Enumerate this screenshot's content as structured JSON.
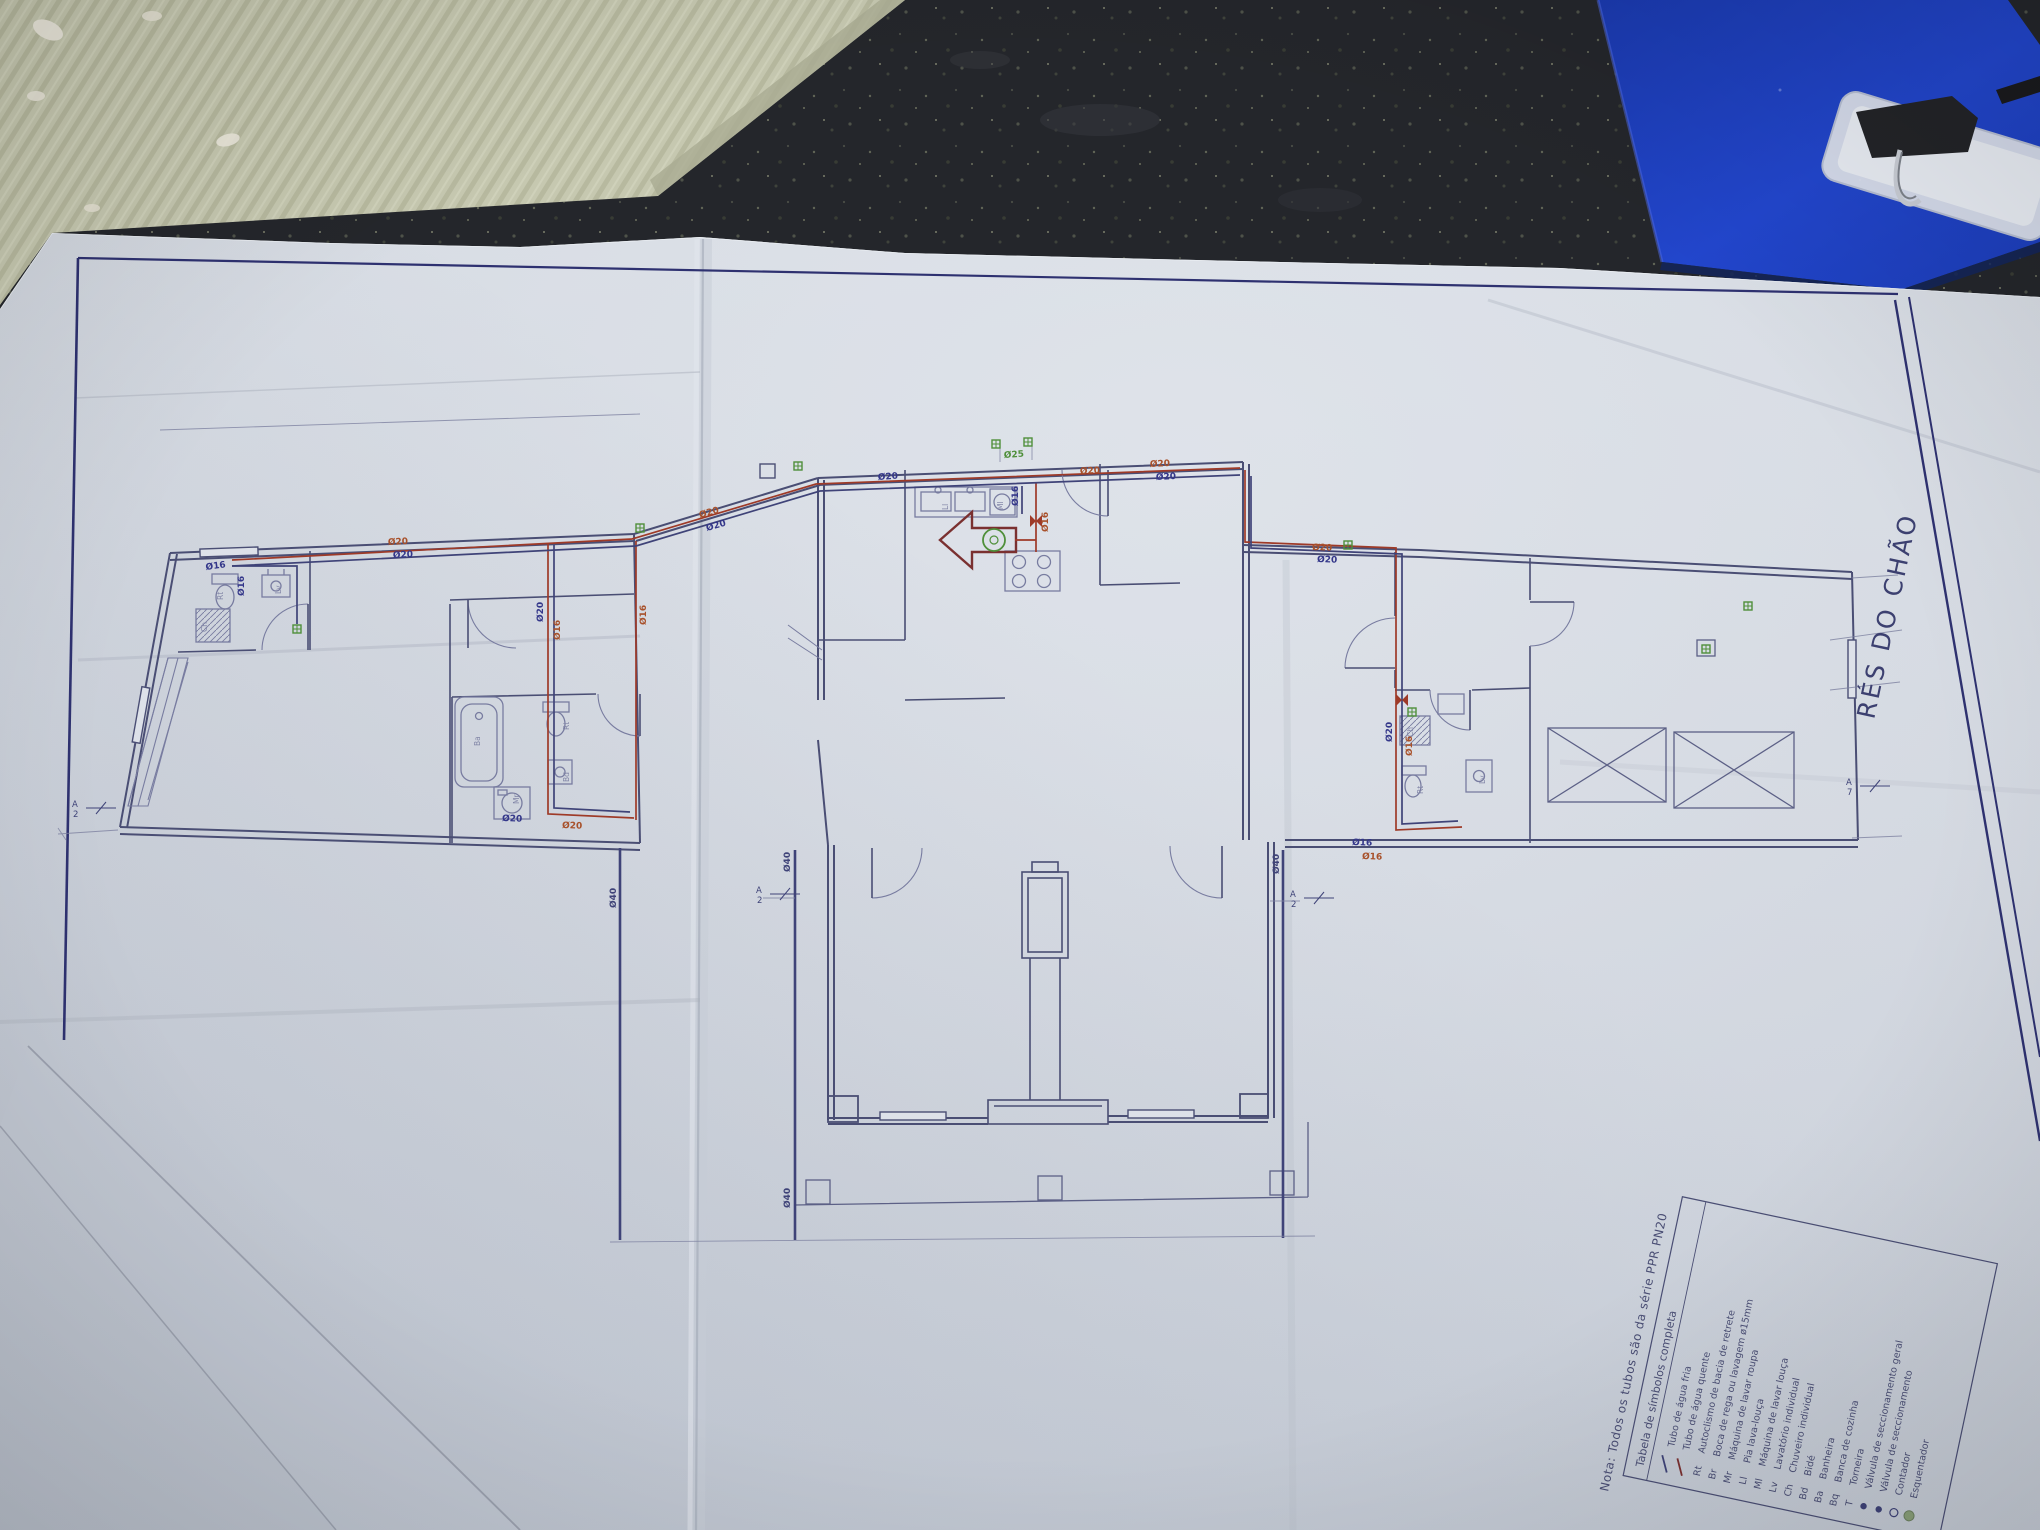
{
  "scene": {
    "description": "photo of a plumbing floor-plan blueprint lying on a dark speckled countertop",
    "objects": [
      "corrugated-cardboard",
      "dark-countertop",
      "blue-folder",
      "clipboard-clip",
      "blueprint-sheet"
    ]
  },
  "sheet": {
    "title": "RÉS DO CHÃO",
    "note": "Nota:  Todos os tubos são da série PPR PN20",
    "legend": {
      "title": "Tabela de símbolos completa",
      "rows": [
        {
          "symbol": "line-cold",
          "abbrev": "",
          "label": "Tubo de água fria"
        },
        {
          "symbol": "line-hot",
          "abbrev": "",
          "label": "Tubo de água quente"
        },
        {
          "symbol": "text",
          "abbrev": "Rt",
          "label": "Autoclismo de bacia de retrete"
        },
        {
          "symbol": "text",
          "abbrev": "Br",
          "label": "Boca de rega ou lavagem ø15mm"
        },
        {
          "symbol": "text",
          "abbrev": "Mr",
          "label": "Máquina de lavar roupa"
        },
        {
          "symbol": "text",
          "abbrev": "Ll",
          "label": "Pia lava-louça"
        },
        {
          "symbol": "text",
          "abbrev": "Ml",
          "label": "Máquina de lavar louça"
        },
        {
          "symbol": "text",
          "abbrev": "Lv",
          "label": "Lavatório individual"
        },
        {
          "symbol": "text",
          "abbrev": "Ch",
          "label": "Chuveiro individual"
        },
        {
          "symbol": "text",
          "abbrev": "Bd",
          "label": "Bidé"
        },
        {
          "symbol": "text",
          "abbrev": "Ba",
          "label": "Banheira"
        },
        {
          "symbol": "text",
          "abbrev": "Bq",
          "label": "Banca de cozinha"
        },
        {
          "symbol": "text",
          "abbrev": "T",
          "label": "Torneira"
        },
        {
          "symbol": "dot",
          "abbrev": "",
          "label": "Válvula de seccionamento geral"
        },
        {
          "symbol": "dot",
          "abbrev": "",
          "label": "Válvula de seccionamento"
        },
        {
          "symbol": "circle",
          "abbrev": "",
          "label": "Contador"
        },
        {
          "symbol": "disc",
          "abbrev": "",
          "label": "Esquentador"
        }
      ]
    },
    "pipe_labels": [
      {
        "t": "Ø16",
        "c": "cold",
        "x": 206,
        "y": 570,
        "r": -8
      },
      {
        "t": "Ø20",
        "c": "hot",
        "x": 388,
        "y": 545,
        "r": -3
      },
      {
        "t": "Ø20",
        "c": "cold",
        "x": 393,
        "y": 558,
        "r": -3
      },
      {
        "t": "Ø20",
        "c": "cold",
        "x": 543,
        "y": 622,
        "r": -90
      },
      {
        "t": "Ø16",
        "c": "hot",
        "x": 560,
        "y": 640,
        "r": -90
      },
      {
        "t": "Ø16",
        "c": "hot",
        "x": 646,
        "y": 625,
        "r": -90
      },
      {
        "t": "Ø20",
        "c": "hot",
        "x": 700,
        "y": 518,
        "r": -16
      },
      {
        "t": "Ø20",
        "c": "cold",
        "x": 707,
        "y": 531,
        "r": -16
      },
      {
        "t": "Ø20",
        "c": "cold",
        "x": 878,
        "y": 480,
        "r": -4
      },
      {
        "t": "Ø20",
        "c": "hot",
        "x": 1080,
        "y": 474,
        "r": -3
      },
      {
        "t": "Ø16",
        "c": "cold",
        "x": 1018,
        "y": 506,
        "r": -90
      },
      {
        "t": "Ø16",
        "c": "hot",
        "x": 1048,
        "y": 532,
        "r": -90
      },
      {
        "t": "Ø25",
        "c": "green",
        "x": 1004,
        "y": 458,
        "r": -4
      },
      {
        "t": "Ø20",
        "c": "hot",
        "x": 1150,
        "y": 467,
        "r": -3
      },
      {
        "t": "Ø20",
        "c": "cold",
        "x": 1156,
        "y": 480,
        "r": -3
      },
      {
        "t": "Ø20",
        "c": "hot",
        "x": 1312,
        "y": 550,
        "r": 2
      },
      {
        "t": "Ø20",
        "c": "cold",
        "x": 1317,
        "y": 562,
        "r": 2
      },
      {
        "t": "Ø20",
        "c": "cold",
        "x": 1392,
        "y": 742,
        "r": -90
      },
      {
        "t": "Ø16",
        "c": "hot",
        "x": 1412,
        "y": 756,
        "r": -90
      },
      {
        "t": "Ø16",
        "c": "cold",
        "x": 1352,
        "y": 845,
        "r": 2
      },
      {
        "t": "Ø16",
        "c": "hot",
        "x": 1362,
        "y": 859,
        "r": 2
      },
      {
        "t": "Ø20",
        "c": "cold",
        "x": 502,
        "y": 821,
        "r": 2
      },
      {
        "t": "Ø20",
        "c": "hot",
        "x": 562,
        "y": 828,
        "r": 2
      },
      {
        "t": "Ø40",
        "c": "ink",
        "x": 790,
        "y": 872,
        "r": -90
      },
      {
        "t": "Ø40",
        "c": "ink",
        "x": 790,
        "y": 1208,
        "r": -90
      },
      {
        "t": "Ø40",
        "c": "ink",
        "x": 1279,
        "y": 874,
        "r": -90
      },
      {
        "t": "Ø40",
        "c": "ink",
        "x": 616,
        "y": 908,
        "r": -90
      },
      {
        "t": "Ø16",
        "c": "cold",
        "x": 244,
        "y": 596,
        "r": -90
      }
    ],
    "fixture_labels": [
      {
        "t": "Rt",
        "x": 223,
        "y": 600
      },
      {
        "t": "Lv",
        "x": 281,
        "y": 594
      },
      {
        "t": "Ch",
        "x": 207,
        "y": 632
      },
      {
        "t": "Ba",
        "x": 480,
        "y": 746
      },
      {
        "t": "Rt",
        "x": 569,
        "y": 730
      },
      {
        "t": "Bd",
        "x": 569,
        "y": 782
      },
      {
        "t": "Mr",
        "x": 519,
        "y": 804
      },
      {
        "t": "Ll",
        "x": 948,
        "y": 510
      },
      {
        "t": "Ml",
        "x": 1003,
        "y": 510
      },
      {
        "t": "Rt",
        "x": 1423,
        "y": 794
      },
      {
        "t": "Lv",
        "x": 1485,
        "y": 784
      },
      {
        "t": "Ch",
        "x": 1413,
        "y": 737
      }
    ],
    "markers": [
      {
        "t": "A2",
        "x": 80,
        "y": 810
      },
      {
        "t": "A2",
        "x": 764,
        "y": 896
      },
      {
        "t": "A2",
        "x": 1298,
        "y": 900
      },
      {
        "t": "A7",
        "x": 1854,
        "y": 788
      }
    ],
    "green_markers": [
      {
        "x": 297,
        "y": 629
      },
      {
        "x": 640,
        "y": 528
      },
      {
        "x": 798,
        "y": 466
      },
      {
        "x": 996,
        "y": 444
      },
      {
        "x": 1028,
        "y": 442
      },
      {
        "x": 1348,
        "y": 545
      },
      {
        "x": 1412,
        "y": 712
      },
      {
        "x": 1706,
        "y": 649
      },
      {
        "x": 1748,
        "y": 606
      }
    ]
  },
  "colors": {
    "cold": "#34378a",
    "hot": "#a8512b",
    "green": "#4f8f3a",
    "ink": "#3f4378",
    "wall": "#4a4e74",
    "furniture": "#787ca0",
    "paper": "#cfd4dd",
    "folder_blue": "#1d3fc0",
    "cardboard": "#c6c8b0",
    "countertop": "#24262b"
  }
}
